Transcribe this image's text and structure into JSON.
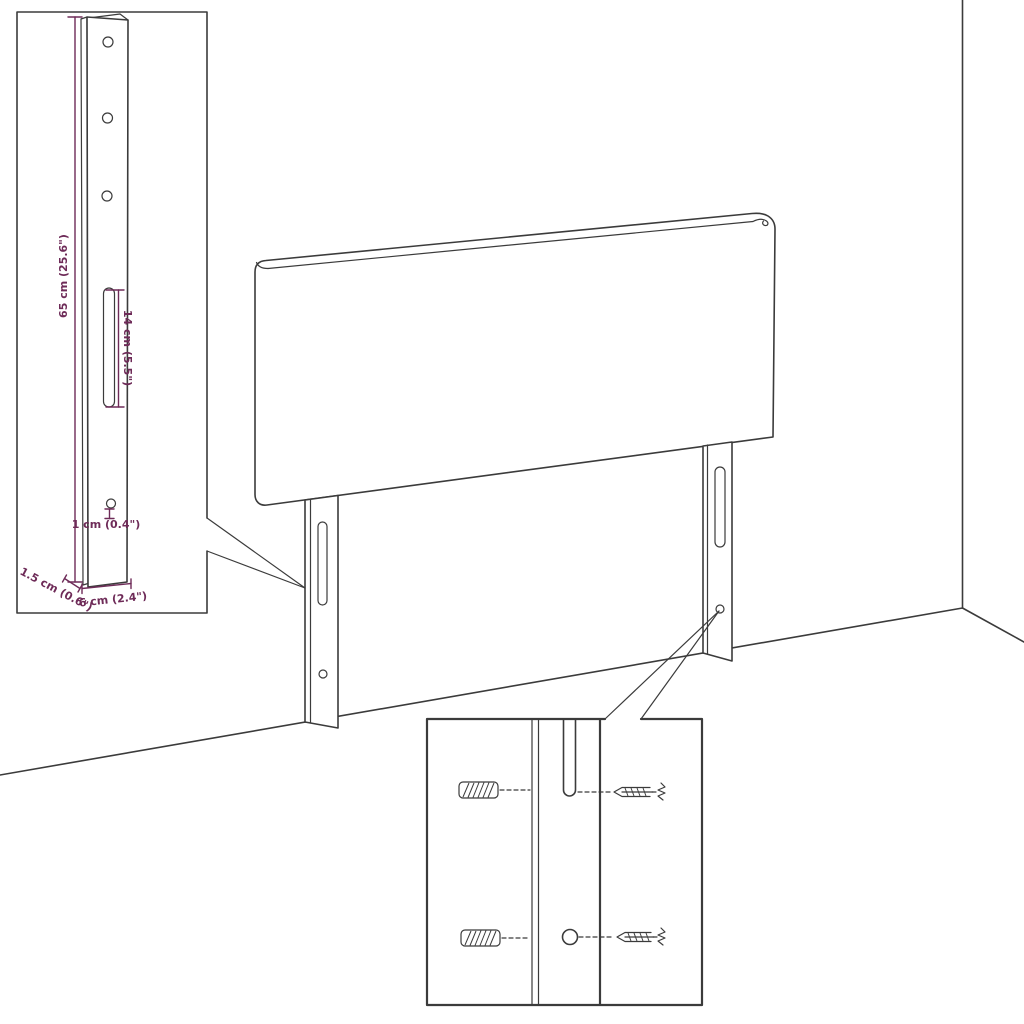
{
  "colors": {
    "line": "#3b3b3b",
    "dimension": "#6e2b58",
    "background": "#ffffff"
  },
  "labels": {
    "leg_height": "65 cm (25.6\")",
    "slot_length": "14 cm (5.5\")",
    "hole_diameter": "1 cm (0.4\")",
    "leg_depth": "1.5 cm (0.6\")",
    "leg_width": "6 cm (2.4\")"
  }
}
